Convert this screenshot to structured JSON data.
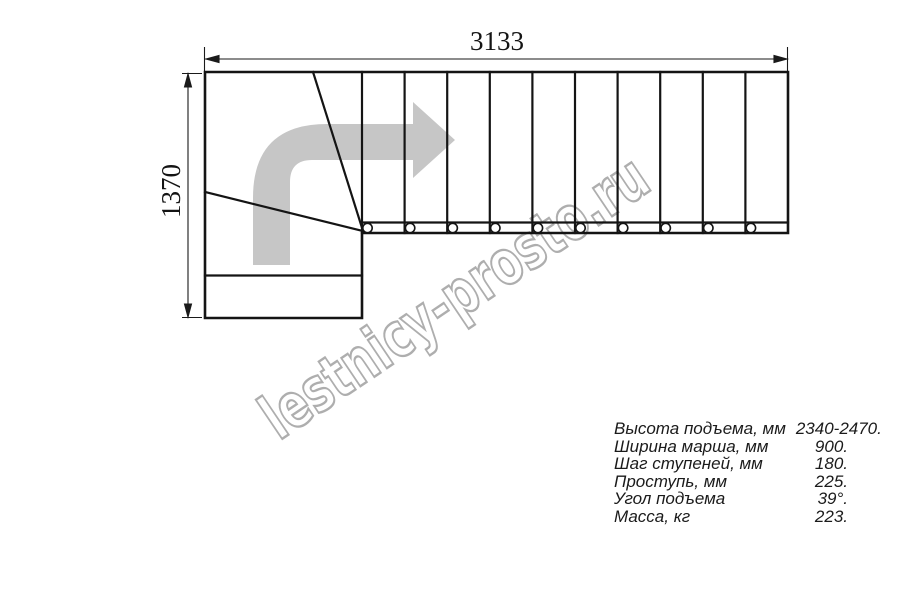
{
  "drawing": {
    "type": "L-shaped staircase plan, top view",
    "width_dim": {
      "label": "3133"
    },
    "height_dim": {
      "label": "1370"
    },
    "straight_steps_count": 10,
    "winder_steps_count": 3,
    "colors": {
      "line": "#141414",
      "direction_arrow_fill": "#c6c6c6",
      "watermark_stroke": "#aeaeae",
      "background": "#ffffff"
    }
  },
  "watermark": {
    "text": "lestnicy-prosto.ru"
  },
  "specs": {
    "rows": [
      {
        "label": "Высота подъема, мм",
        "value": "2340-2470."
      },
      {
        "label": "Ширина марша, мм",
        "value": "900."
      },
      {
        "label": "Шаг ступеней, мм",
        "value": "180."
      },
      {
        "label": "Проступь, мм",
        "value": "225."
      },
      {
        "label": "Угол подъема",
        "value": "39°."
      },
      {
        "label": "Масса, кг",
        "value": "223."
      }
    ]
  }
}
